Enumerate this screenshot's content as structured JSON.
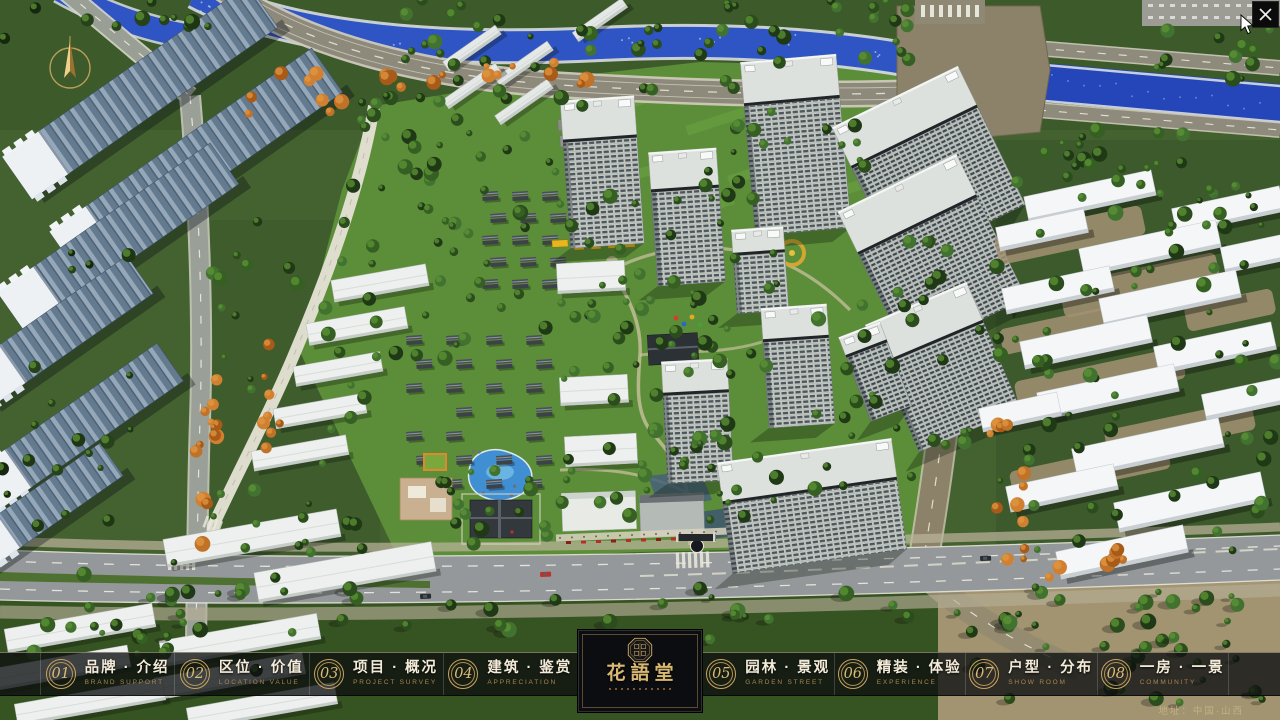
{
  "nav": {
    "items": [
      {
        "number": "01",
        "label": "品牌 · 介绍",
        "sublabel": "BRAND SUPPORT"
      },
      {
        "number": "02",
        "label": "区位 · 价值",
        "sublabel": "LOCATION VALUE"
      },
      {
        "number": "03",
        "label": "项目 · 概况",
        "sublabel": "PROJECT SURVEY"
      },
      {
        "number": "04",
        "label": "建筑 · 鉴赏",
        "sublabel": "APPRECIATION"
      },
      {
        "number": "05",
        "label": "园林 · 景观",
        "sublabel": "GARDEN STREET"
      },
      {
        "number": "06",
        "label": "精装 · 体验",
        "sublabel": "EXPERIENCE"
      },
      {
        "number": "07",
        "label": "户型 · 分布",
        "sublabel": "SHOW ROOM"
      },
      {
        "number": "08",
        "label": "一房 · 一景",
        "sublabel": "COMMUNITY"
      }
    ]
  },
  "logo": {
    "title": "花語堂"
  },
  "footer": {
    "address": "地址：中国·山西"
  },
  "icons": {
    "close": "close-x",
    "compass": "north-arrow"
  },
  "colors": {
    "gold": "#c9a45f",
    "gold_bright": "#e6c87e",
    "bar_background": "rgba(13,15,17,0.78)",
    "panel_background": "#0b0d10",
    "river_blue": "#2f55c4",
    "map_green": "#44622f"
  }
}
